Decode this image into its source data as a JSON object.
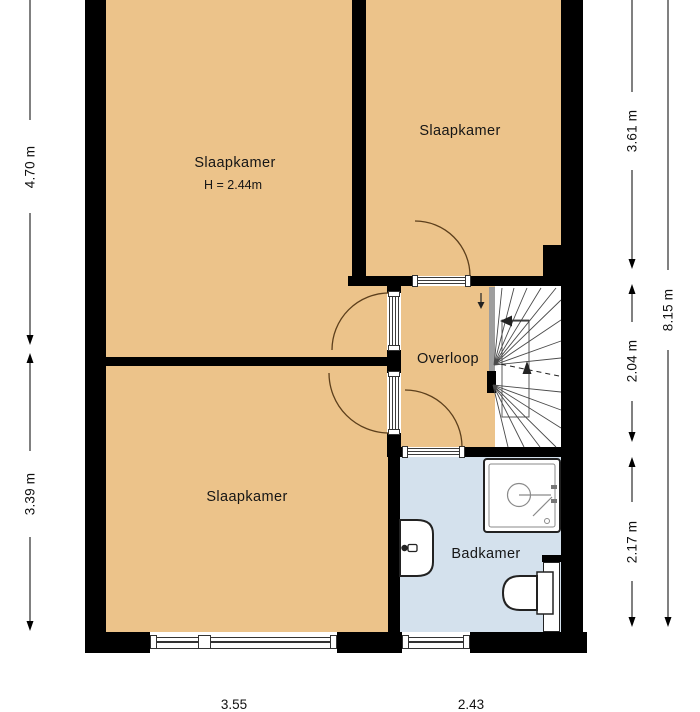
{
  "plan": {
    "type": "floor-plan-upper-storey",
    "rooms": [
      {
        "id": "bedroom-top-left",
        "label": "Slaapkamer",
        "ceiling_height": "H = 2.44m"
      },
      {
        "id": "bedroom-top-right",
        "label": "Slaapkamer"
      },
      {
        "id": "bedroom-bottom-left",
        "label": "Slaapkamer"
      },
      {
        "id": "landing",
        "label": "Overloop"
      },
      {
        "id": "bathroom",
        "label": "Badkamer"
      }
    ],
    "fixtures": [
      "staircase",
      "shower",
      "sink",
      "toilet"
    ],
    "dimensions": {
      "left": [
        {
          "label": "4.70 m"
        },
        {
          "label": "3.39 m"
        }
      ],
      "right": [
        {
          "label": "3.61 m"
        },
        {
          "label": "2.04 m"
        },
        {
          "label": "2.17 m"
        },
        {
          "label": "8.15 m"
        }
      ],
      "bottom": [
        {
          "label": "3.55"
        },
        {
          "label": "2.43"
        }
      ]
    },
    "colors": {
      "floor_tan": "#ECC38A",
      "floor_blue": "#D4E1ED",
      "wall": "#000000",
      "detail_line": "#3c3c3c",
      "door_arc": "#5C3F1C"
    }
  }
}
